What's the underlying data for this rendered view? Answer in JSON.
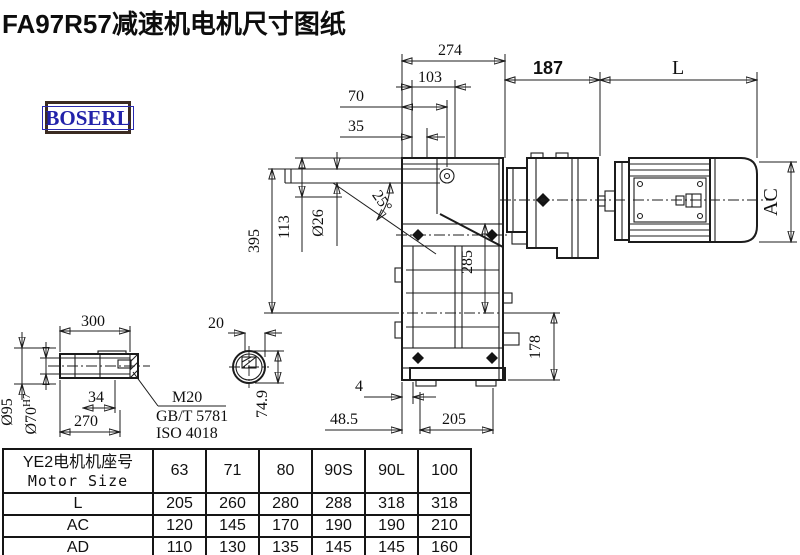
{
  "title": "FA97R57减速机电机尺寸图纸",
  "logo": {
    "text": "BOSERL"
  },
  "drawing": {
    "dims": {
      "w274": "274",
      "w103": "103",
      "w70": "70",
      "w35": "35",
      "w187": "187",
      "wL": "L",
      "ac": "AC",
      "angle25": "25°",
      "dia26": "Ø26",
      "h113": "113",
      "h395": "395",
      "h285": "285",
      "h178": "178",
      "w4": "4",
      "w48_5": "48.5",
      "w205": "205",
      "s300": "300",
      "s20": "20",
      "dia95": "Ø95",
      "dia70": "Ø70",
      "dia70_tol": "H7",
      "s34": "34",
      "s270": "270",
      "s74_9": "74.9",
      "m20": "M20",
      "gb": "GB/T 5781",
      "iso": "ISO 4018"
    }
  },
  "table": {
    "header_cn": "YE2电机机座号",
    "header_en": "Motor Size",
    "columns": [
      "63",
      "71",
      "80",
      "90S",
      "90L",
      "100"
    ],
    "rows": [
      {
        "label": "L",
        "values": [
          "205",
          "260",
          "280",
          "288",
          "318",
          "318"
        ]
      },
      {
        "label": "AC",
        "values": [
          "120",
          "145",
          "170",
          "190",
          "190",
          "210"
        ]
      },
      {
        "label": "AD",
        "values": [
          "110",
          "130",
          "135",
          "145",
          "145",
          "160"
        ]
      }
    ]
  }
}
